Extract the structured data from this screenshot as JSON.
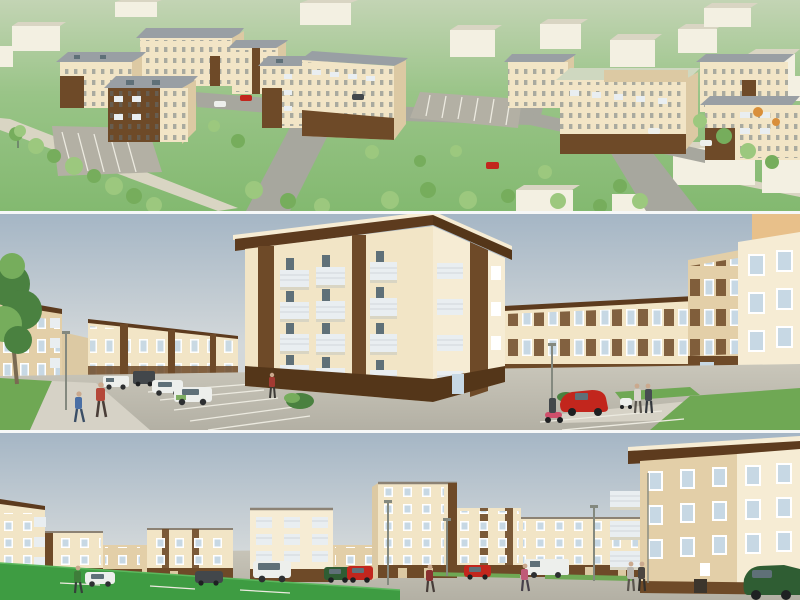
{
  "image": {
    "title": "Housing estate 3D architectural visualization, three stacked views",
    "type": "architectural-rendering"
  },
  "panels": [
    {
      "id": "aerial",
      "label": "Aerial overview of residential estate with apartment blocks, roads, parking lots and trees on green terrain"
    },
    {
      "id": "street-parking",
      "label": "Street-level view of four-storey apartment building with wood-clad accents, parking lot, cars, scooter and pedestrians"
    },
    {
      "id": "street-plaza",
      "label": "Street-level view of cream apartment buildings with brown ground floors, paved plaza, parked cars, lawn and pedestrians"
    }
  ],
  "palette": {
    "sky_top": "#a5b6c5",
    "sky_horizon": "#d3d8da",
    "aerial_green_top": "#c3d4b4",
    "aerial_green": "#99c487",
    "aerial_green_deep": "#83b970",
    "cream": "#f2e5c6",
    "cream_shade": "#dcc9a3",
    "cream_dark": "#e3cfa8",
    "cream_bright": "#f6ecd4",
    "brown": "#6e4a28",
    "brown_dark": "#543619",
    "roof_dark_brown": "#5d3b1e",
    "roof_gray": "#999fa4",
    "roof_gray_light": "#b9bec2",
    "roof_pale_green": "#cfd8c0",
    "white_block": "#f3f0e2",
    "white_block_side": "#d9d5c3",
    "road": "#a7a79e",
    "pavement": "#b3b0a4",
    "pavement_light": "#c9c6ba",
    "sidewalk": "#d6d2c6",
    "grass": "#6fa854",
    "grass_bright": "#3e9c42",
    "tree": "#9cc87e",
    "tree_dark": "#76ad5c",
    "evergreen": "#4a8140",
    "trunk": "#a89c80",
    "window_glass": "#c7d8e4",
    "window_dark": "#5f7078",
    "frame": "#ffffff",
    "rail": "#e9eef1",
    "car_red": "#c2261d",
    "car_white": "#edefec",
    "car_dark": "#42474b",
    "car_green": "#2f5d33",
    "scooter_pink": "#cf4f6b",
    "orange_wall": "#e8c08a",
    "orange_tree": "#d98f3a"
  }
}
